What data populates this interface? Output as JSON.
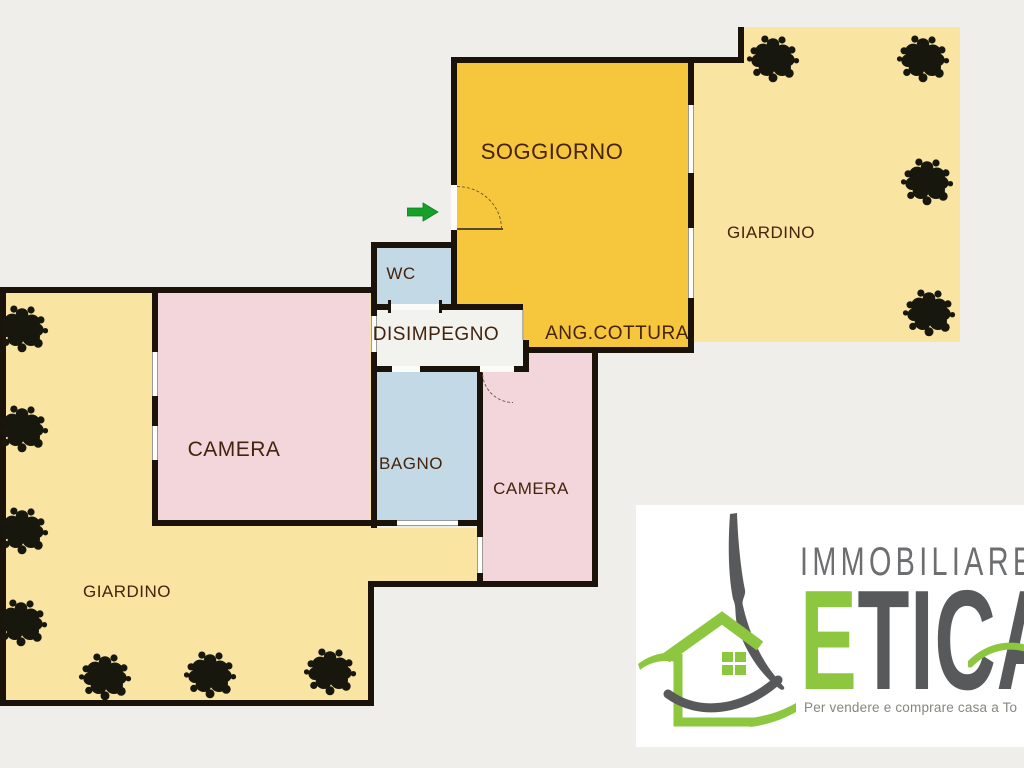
{
  "palette": {
    "bg": "#efeeeb",
    "wall": "#1b1309",
    "gold": "#f6c63d",
    "paleyellow": "#fae4a1",
    "pink": "#f3d6dc",
    "blue": "#c4d9e6",
    "white_room": "#f2f2ee",
    "label": "#44230c",
    "winline": "#9b9b94",
    "tree": "#17170e",
    "green_arrow": "#16a02a",
    "logo_green": "#8dc63f",
    "logo_gray": "#58595b",
    "logo_text_gray": "#6d6e70",
    "tagline_gray": "#87867f"
  },
  "rooms": {
    "soggiorno": {
      "label": "SOGGIORNO",
      "color": "#f6c63d"
    },
    "ang_cottura": {
      "label": "ANG.COTTURA",
      "color": "#f6c63d"
    },
    "wc": {
      "label": "WC",
      "color": "#c4d9e6"
    },
    "disimpegno": {
      "label": "DISIMPEGNO",
      "color": "#f2f2ee"
    },
    "camera1": {
      "label": "CAMERA",
      "color": "#f3d6dc"
    },
    "bagno": {
      "label": "BAGNO",
      "color": "#c4d9e6"
    },
    "camera2": {
      "label": "CAMERA",
      "color": "#f3d6dc"
    },
    "giardino_left": {
      "label": "GIARDINO",
      "color": "#fae4a1"
    },
    "giardino_right": {
      "label": "GIARDINO",
      "color": "#fae4a1"
    }
  },
  "entrance": {
    "direction": "right",
    "arrow_color": "#16a02a"
  },
  "icons": {
    "tree": "shrub-top-view",
    "arrow": "entrance-arrow"
  },
  "logo": {
    "line1": "IMMOBILIARE",
    "brand_first": "E",
    "brand_rest": "TICA",
    "tagline": "Per vendere e comprare casa a To"
  }
}
